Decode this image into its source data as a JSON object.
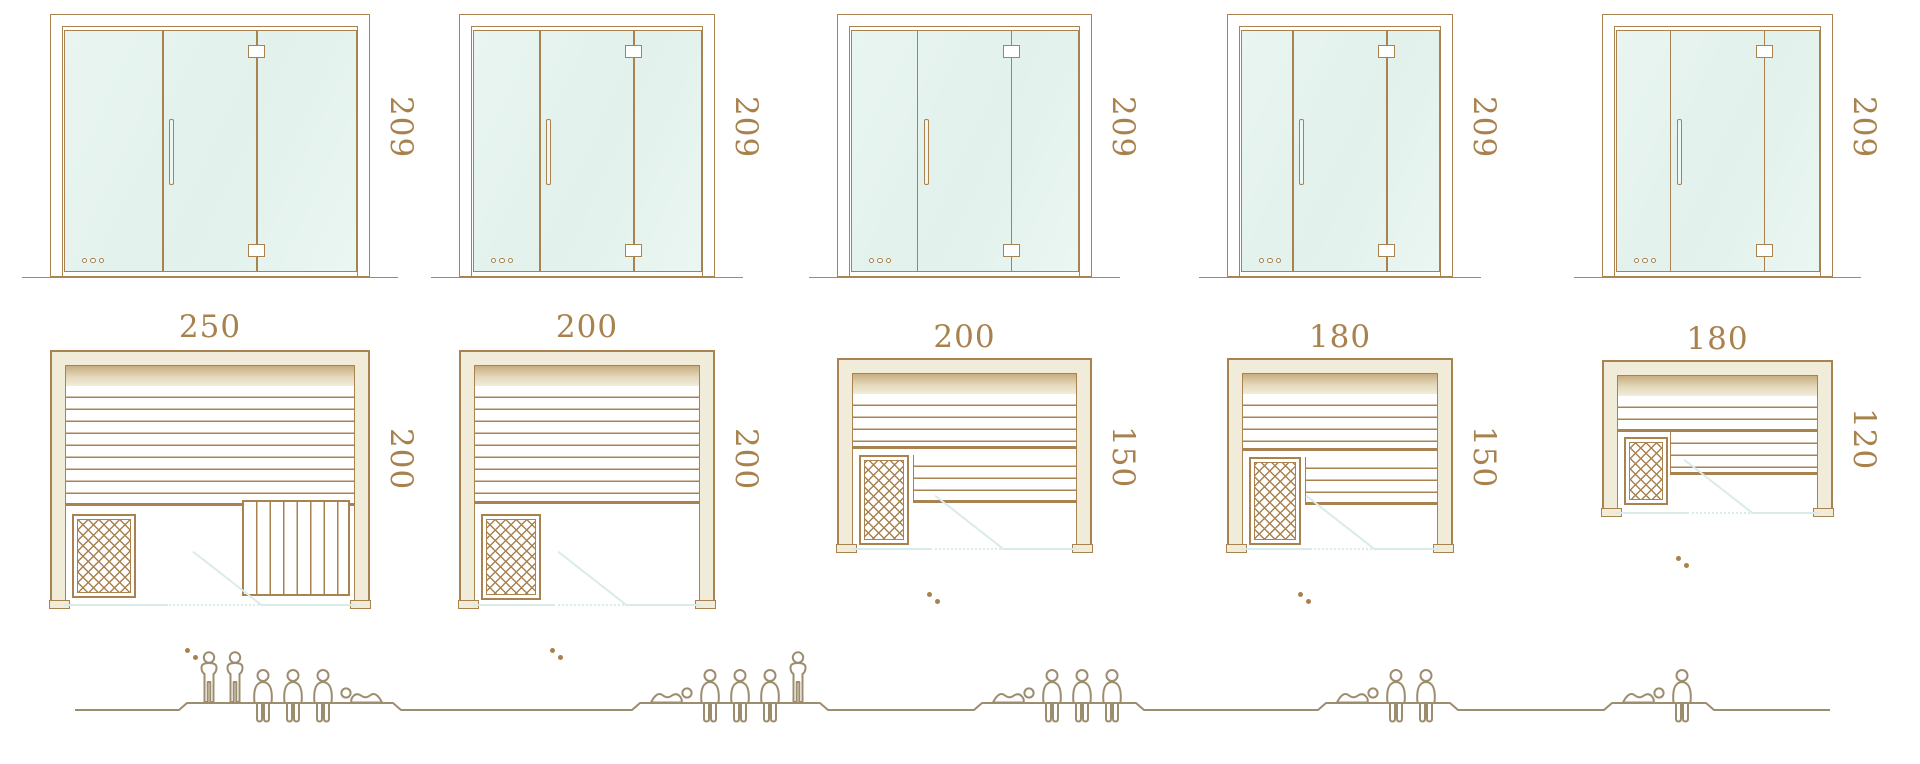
{
  "diagram_title": "sauna-size-comparison",
  "palette": {
    "frame_outline_brown": "#a8824f",
    "dimension_text_brown": "#a8814d",
    "frame_beige_fill": "#f1ebd9",
    "backrest_tan": "#c9ad7e",
    "glass_mint": "#e8f4f0",
    "door_swing_cyan": "#d9ece9",
    "figure_outline": "#9d8d6f"
  },
  "units": [
    {
      "name": "sauna-250x200",
      "elevation_height": "209",
      "plan_width": "250",
      "plan_depth": "200",
      "capacity": {
        "standing": 2,
        "seated": 3,
        "lying": 1
      },
      "capacity_figures": [
        "standing",
        "standing",
        "seated",
        "seated",
        "seated",
        "lying-flipped"
      ]
    },
    {
      "name": "sauna-200x200",
      "elevation_height": "209",
      "plan_width": "200",
      "plan_depth": "200",
      "capacity": {
        "standing": 1,
        "seated": 3,
        "lying": 1
      },
      "capacity_figures": [
        "lying",
        "seated",
        "seated",
        "seated",
        "standing"
      ]
    },
    {
      "name": "sauna-200x150",
      "elevation_height": "209",
      "plan_width": "200",
      "plan_depth": "150",
      "capacity": {
        "standing": 0,
        "seated": 3,
        "lying": 1
      },
      "capacity_figures": [
        "lying",
        "seated",
        "seated",
        "seated"
      ]
    },
    {
      "name": "sauna-180x150",
      "elevation_height": "209",
      "plan_width": "180",
      "plan_depth": "150",
      "capacity": {
        "standing": 0,
        "seated": 2,
        "lying": 1
      },
      "capacity_figures": [
        "lying",
        "seated",
        "seated"
      ]
    },
    {
      "name": "sauna-180x120",
      "elevation_height": "209",
      "plan_width": "180",
      "plan_depth": "120",
      "capacity": {
        "standing": 0,
        "seated": 1,
        "lying": 1
      },
      "capacity_figures": [
        "lying",
        "seated"
      ]
    }
  ]
}
